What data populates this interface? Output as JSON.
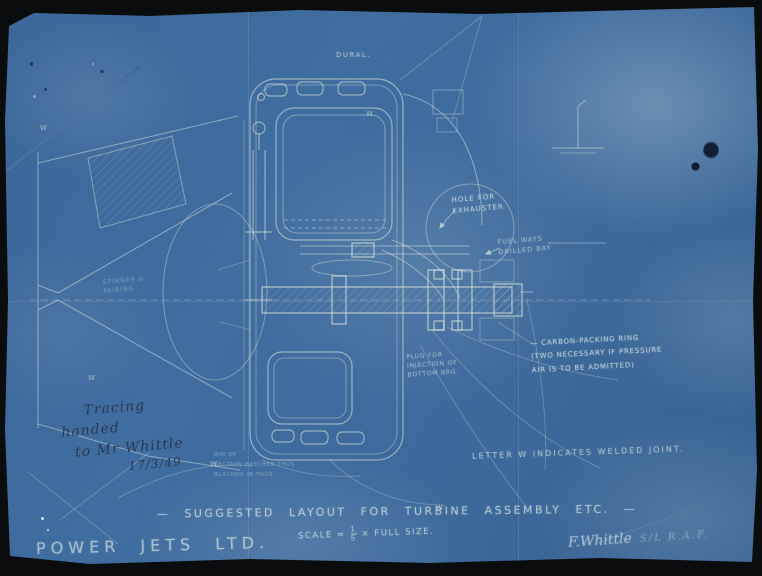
{
  "colors": {
    "paper_blue": "#3c699b",
    "line_white": "#dfeadf",
    "pencil_graphite": "#2f3d52",
    "backdrop": "#0b0c0e"
  },
  "drawing": {
    "material_label": "DURAL.",
    "weld_mark": "W",
    "annotations": {
      "hole": "HOLE FOR\nEXHAUSTER",
      "fuel_ways": "FUEL WAYS\nDRILLED BAY",
      "carbon_ring": "— CARBON-PACKING RING\n(TWO NECESSARY IF PRESSURE\nAIR IS TO BE ADMITTED)",
      "welded_note": "LETTER W INDICATES WELDED JOINT.",
      "plug": "PLUG FOR\nINJECTION OF\nBOTTOM BRG.",
      "spinner": "SPINNER &\nFAIRING",
      "rim_note": "RIM OF\nSECTION HATCHED THUS\nBLACKED IN THUS"
    }
  },
  "title_block": {
    "title": "— SUGGESTED LAYOUT FOR TURBINE ASSEMBLY ETC. —",
    "scale_prefix": "SCALE =",
    "scale_numerator": "1",
    "scale_denominator": "5",
    "scale_suffix": "× FULL SIZE.",
    "company": "POWER JETS LTD."
  },
  "handwriting": {
    "lines": [
      "Tracing",
      "handed",
      "to Mr Whittle",
      "17/3/49"
    ]
  },
  "signature": {
    "name": "F.Whittle",
    "suffix": "S/L R.A.F."
  }
}
